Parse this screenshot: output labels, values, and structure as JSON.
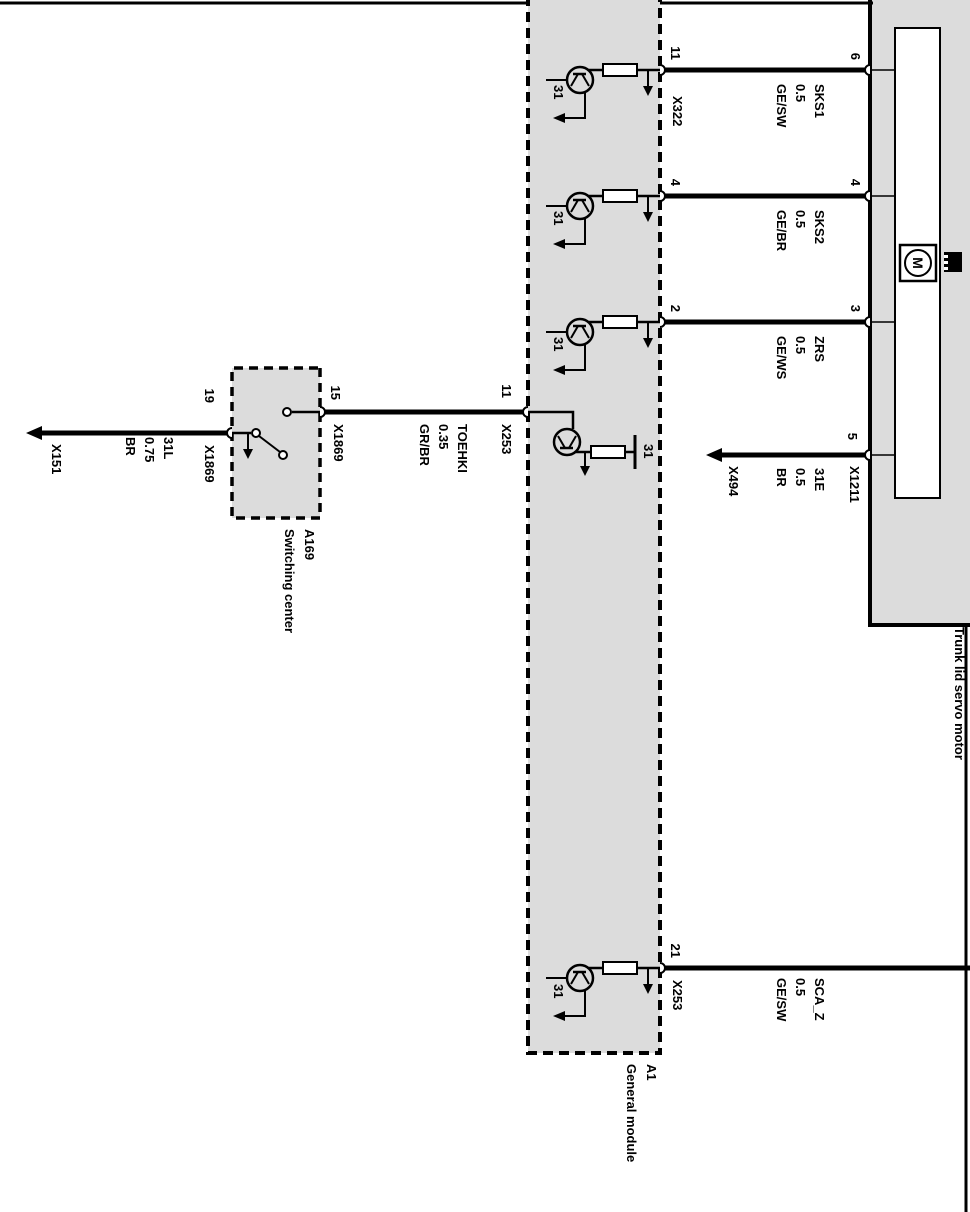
{
  "boxes": {
    "general_module": {
      "id": "A1",
      "name": "General module"
    },
    "switching_center": {
      "id": "A169",
      "name": "Switching center"
    },
    "servo_motor": {
      "name": "Trunk lid servo motor"
    }
  },
  "w": {
    "sks1": {
      "signal": "SKS1",
      "gauge": "0.5",
      "color": "GE/SW",
      "module_pin": "11",
      "module_conn": "X322",
      "motor_pin": "6"
    },
    "sks2": {
      "signal": "SKS2",
      "gauge": "0.5",
      "color": "GE/BR",
      "module_pin": "4",
      "motor_pin": "4"
    },
    "zrs": {
      "signal": "ZRS",
      "gauge": "0.5",
      "color": "GE/WS",
      "module_pin": "2",
      "motor_pin": "3"
    },
    "e31": {
      "signal": "31E",
      "gauge": "0.5",
      "color": "BR",
      "motor_pin": "5",
      "motor_conn": "X1211",
      "ground_conn": "X494"
    },
    "toehki": {
      "signal": "TOEHKI",
      "gauge": "0.35",
      "color": "GR/BR",
      "module_pin": "11",
      "module_conn": "X253",
      "switch_pin": "15",
      "switch_conn": "X1869"
    },
    "l31": {
      "signal": "31L",
      "gauge": "0.75",
      "color": "BR",
      "switch_pin": "19",
      "switch_conn": "X1869",
      "ground_conn": "X151"
    },
    "scaz": {
      "signal": "SCA_Z",
      "gauge": "0.5",
      "color": "GE/SW",
      "module_pin": "21",
      "module_conn": "X253"
    }
  },
  "ground_label": "31",
  "motor_symbol": "M",
  "colors": {
    "box_fill": "#dcdcdc",
    "line": "#000000",
    "background": "#ffffff"
  }
}
